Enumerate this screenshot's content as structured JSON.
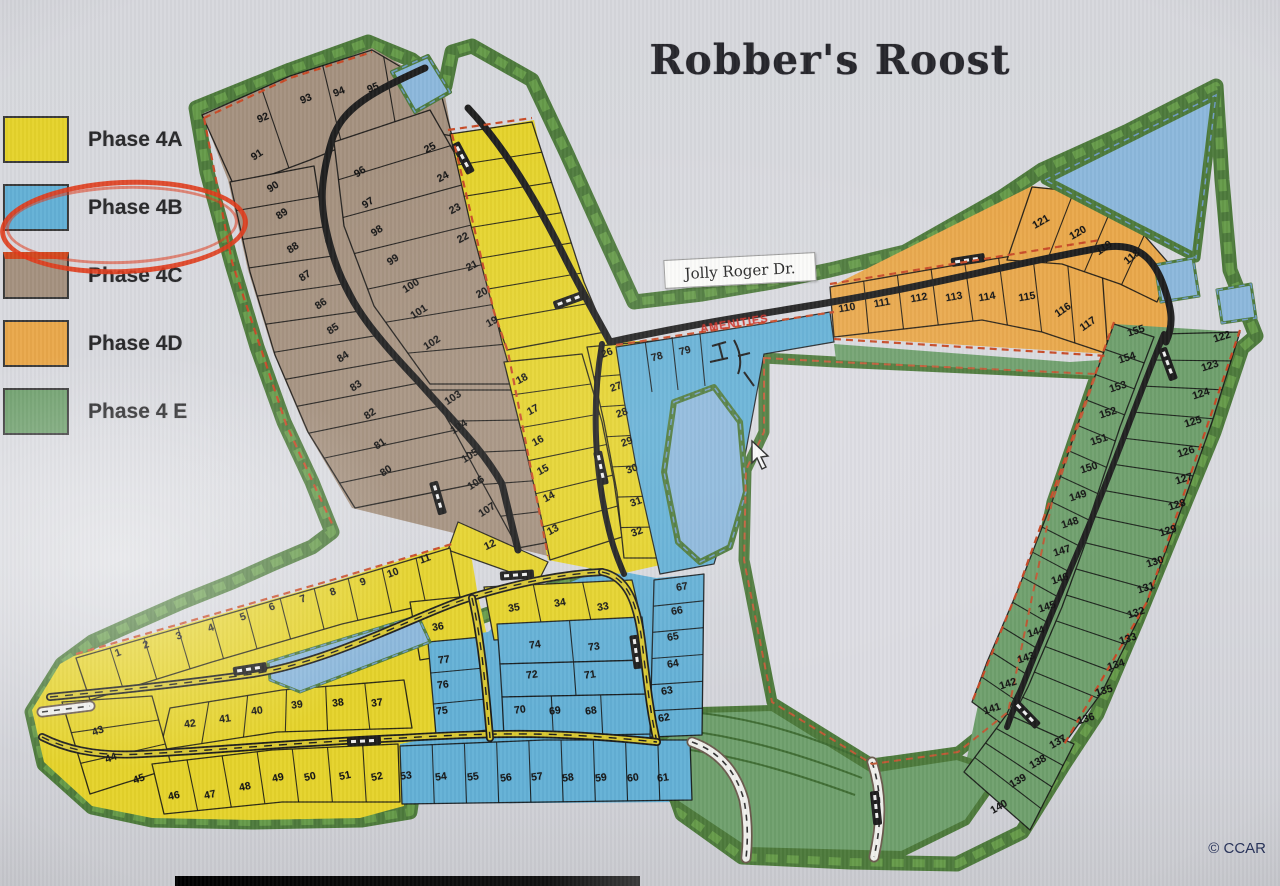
{
  "title": "Robber's Roost",
  "watermark": "© CCAR",
  "legend": {
    "items": [
      {
        "label": "Phase 4A",
        "color": "#e5d32b"
      },
      {
        "label": "Phase 4B",
        "color": "#63b0d6",
        "circled": true
      },
      {
        "label": "Phase 4C",
        "color": "#a5917f",
        "accent": "#d1491f"
      },
      {
        "label": "Phase 4D",
        "color": "#e9a84b"
      },
      {
        "label": "Phase 4 E",
        "color": "#6fa06d"
      }
    ]
  },
  "map": {
    "street_label": "Jolly Roger Dr.",
    "annotation": "AMENITIES",
    "phases": [
      {
        "name": "Phase 4A",
        "color": "#e5d32b",
        "lots": [
          [
            "1",
            118,
            653,
            -20
          ],
          [
            "2",
            146,
            645,
            -20
          ],
          [
            "3",
            179,
            636,
            -20
          ],
          [
            "4",
            211,
            628,
            -20
          ],
          [
            "5",
            243,
            617,
            -20
          ],
          [
            "6",
            272,
            607,
            -20
          ],
          [
            "7",
            303,
            599,
            -20
          ],
          [
            "8",
            333,
            592,
            -20
          ],
          [
            "9",
            363,
            582,
            -20
          ],
          [
            "10",
            393,
            573,
            -20
          ],
          [
            "11",
            425,
            559,
            -20
          ],
          [
            "12",
            490,
            545,
            -25
          ],
          [
            "13",
            553,
            530,
            -28
          ],
          [
            "14",
            549,
            497,
            -28
          ],
          [
            "15",
            543,
            470,
            -28
          ],
          [
            "16",
            538,
            441,
            -28
          ],
          [
            "17",
            533,
            410,
            -28
          ],
          [
            "18",
            522,
            379,
            -28
          ],
          [
            "19",
            492,
            322,
            -28
          ],
          [
            "20",
            482,
            293,
            -28
          ],
          [
            "21",
            472,
            266,
            -28
          ],
          [
            "22",
            463,
            238,
            -28
          ],
          [
            "23",
            455,
            209,
            -28
          ],
          [
            "24",
            443,
            177,
            -28
          ],
          [
            "25",
            430,
            148,
            -28
          ],
          [
            "26",
            607,
            353,
            -20
          ],
          [
            "27",
            616,
            387,
            -20
          ],
          [
            "28",
            622,
            413,
            -20
          ],
          [
            "29",
            627,
            442,
            -20
          ],
          [
            "30",
            632,
            469,
            -20
          ],
          [
            "31",
            636,
            502,
            -20
          ],
          [
            "32",
            637,
            532,
            -20
          ],
          [
            "33",
            603,
            607,
            -10
          ],
          [
            "34",
            560,
            603,
            -10
          ],
          [
            "35",
            514,
            608,
            -10
          ],
          [
            "36",
            438,
            627,
            -10
          ],
          [
            "37",
            377,
            703,
            -8
          ],
          [
            "38",
            338,
            703,
            -8
          ],
          [
            "39",
            297,
            705,
            -8
          ],
          [
            "40",
            257,
            711,
            -8
          ],
          [
            "41",
            225,
            719,
            -8
          ],
          [
            "42",
            190,
            724,
            -8
          ],
          [
            "43",
            98,
            731,
            -20
          ],
          [
            "44",
            111,
            758,
            -20
          ],
          [
            "45",
            139,
            779,
            -20
          ],
          [
            "46",
            174,
            796,
            -12
          ],
          [
            "47",
            210,
            795,
            -12
          ],
          [
            "48",
            245,
            787,
            -12
          ],
          [
            "49",
            278,
            778,
            -12
          ],
          [
            "50",
            310,
            777,
            -12
          ],
          [
            "51",
            345,
            776,
            -12
          ],
          [
            "52",
            377,
            777,
            -12
          ]
        ]
      },
      {
        "name": "Phase 4B",
        "color": "#63b0d6",
        "lots": [
          [
            "53",
            406,
            776,
            -8
          ],
          [
            "54",
            441,
            777,
            -8
          ],
          [
            "55",
            473,
            777,
            -8
          ],
          [
            "56",
            506,
            778,
            -8
          ],
          [
            "57",
            537,
            777,
            -8
          ],
          [
            "58",
            568,
            778,
            -8
          ],
          [
            "59",
            601,
            778,
            -8
          ],
          [
            "60",
            633,
            778,
            -8
          ],
          [
            "61",
            663,
            778,
            -8
          ],
          [
            "62",
            664,
            718,
            -10
          ],
          [
            "63",
            667,
            691,
            -10
          ],
          [
            "64",
            673,
            664,
            -10
          ],
          [
            "65",
            673,
            637,
            -10
          ],
          [
            "66",
            677,
            611,
            -10
          ],
          [
            "67",
            682,
            587,
            -10
          ],
          [
            "68",
            591,
            711,
            -8
          ],
          [
            "69",
            555,
            711,
            -8
          ],
          [
            "70",
            520,
            710,
            -8
          ],
          [
            "71",
            590,
            675,
            -8
          ],
          [
            "72",
            532,
            675,
            -8
          ],
          [
            "73",
            594,
            647,
            -8
          ],
          [
            "74",
            535,
            645,
            -8
          ],
          [
            "75",
            442,
            711,
            -8
          ],
          [
            "76",
            443,
            685,
            -8
          ],
          [
            "77",
            444,
            660,
            -8
          ],
          [
            "78",
            657,
            357,
            -15
          ],
          [
            "79",
            685,
            351,
            -15
          ]
        ]
      },
      {
        "name": "Phase 4C",
        "color": "#a5917f",
        "lots": [
          [
            "80",
            386,
            471,
            -33
          ],
          [
            "81",
            380,
            444,
            -33
          ],
          [
            "82",
            370,
            414,
            -33
          ],
          [
            "83",
            356,
            386,
            -33
          ],
          [
            "84",
            343,
            357,
            -33
          ],
          [
            "85",
            333,
            329,
            -33
          ],
          [
            "86",
            321,
            304,
            -33
          ],
          [
            "87",
            305,
            276,
            -33
          ],
          [
            "88",
            293,
            248,
            -33
          ],
          [
            "89",
            282,
            214,
            -33
          ],
          [
            "90",
            273,
            187,
            -33
          ],
          [
            "91",
            257,
            155,
            -33
          ],
          [
            "92",
            263,
            118,
            -22
          ],
          [
            "93",
            306,
            99,
            -22
          ],
          [
            "94",
            339,
            92,
            -22
          ],
          [
            "95",
            373,
            88,
            -22
          ],
          [
            "96",
            360,
            172,
            -33
          ],
          [
            "97",
            368,
            203,
            -33
          ],
          [
            "98",
            377,
            231,
            -33
          ],
          [
            "99",
            393,
            260,
            -33
          ],
          [
            "100",
            411,
            286,
            -33
          ],
          [
            "101",
            419,
            312,
            -33
          ],
          [
            "102",
            432,
            343,
            -33
          ],
          [
            "103",
            453,
            398,
            -33
          ],
          [
            "104",
            459,
            427,
            -33
          ],
          [
            "105",
            470,
            456,
            -33
          ],
          [
            "106",
            476,
            483,
            -33
          ],
          [
            "107",
            487,
            510,
            -33
          ]
        ]
      },
      {
        "name": "Phase 4D",
        "color": "#e9a84b",
        "lots": [
          [
            "110",
            847,
            308,
            -10
          ],
          [
            "111",
            882,
            303,
            -10
          ],
          [
            "112",
            919,
            298,
            -10
          ],
          [
            "113",
            954,
            297,
            -10
          ],
          [
            "114",
            987,
            297,
            -10
          ],
          [
            "115",
            1027,
            297,
            -10
          ],
          [
            "116",
            1063,
            310,
            -35
          ],
          [
            "117",
            1088,
            324,
            -35
          ],
          [
            "118",
            1132,
            257,
            -40
          ],
          [
            "119",
            1104,
            248,
            -35
          ],
          [
            "120",
            1078,
            233,
            -30
          ],
          [
            "121",
            1041,
            222,
            -30
          ]
        ]
      },
      {
        "name": "Phase 4 E",
        "color": "#6fa06d",
        "lots": [
          [
            "122",
            1222,
            337,
            -18
          ],
          [
            "123",
            1210,
            366,
            -18
          ],
          [
            "124",
            1201,
            394,
            -18
          ],
          [
            "125",
            1193,
            422,
            -18
          ],
          [
            "126",
            1186,
            452,
            -18
          ],
          [
            "127",
            1184,
            479,
            -18
          ],
          [
            "128",
            1177,
            505,
            -18
          ],
          [
            "129",
            1168,
            531,
            -18
          ],
          [
            "130",
            1155,
            562,
            -18
          ],
          [
            "131",
            1146,
            588,
            -18
          ],
          [
            "132",
            1136,
            613,
            -18
          ],
          [
            "133",
            1128,
            639,
            -18
          ],
          [
            "134",
            1116,
            665,
            -18
          ],
          [
            "135",
            1104,
            691,
            -18
          ],
          [
            "136",
            1086,
            719,
            -18
          ],
          [
            "137",
            1058,
            742,
            -30
          ],
          [
            "138",
            1038,
            762,
            -30
          ],
          [
            "139",
            1018,
            781,
            -30
          ],
          [
            "140",
            999,
            807,
            -30
          ],
          [
            "141",
            992,
            709,
            -18
          ],
          [
            "142",
            1008,
            684,
            -18
          ],
          [
            "143",
            1026,
            658,
            -18
          ],
          [
            "144",
            1036,
            632,
            -18
          ],
          [
            "145",
            1047,
            607,
            -18
          ],
          [
            "146",
            1060,
            579,
            -18
          ],
          [
            "147",
            1062,
            551,
            -18
          ],
          [
            "148",
            1070,
            523,
            -18
          ],
          [
            "149",
            1078,
            496,
            -18
          ],
          [
            "150",
            1089,
            468,
            -18
          ],
          [
            "151",
            1099,
            440,
            -18
          ],
          [
            "152",
            1108,
            413,
            -18
          ],
          [
            "153",
            1118,
            387,
            -18
          ],
          [
            "154",
            1127,
            358,
            -18
          ],
          [
            "155",
            1136,
            331,
            -18
          ]
        ]
      }
    ]
  }
}
